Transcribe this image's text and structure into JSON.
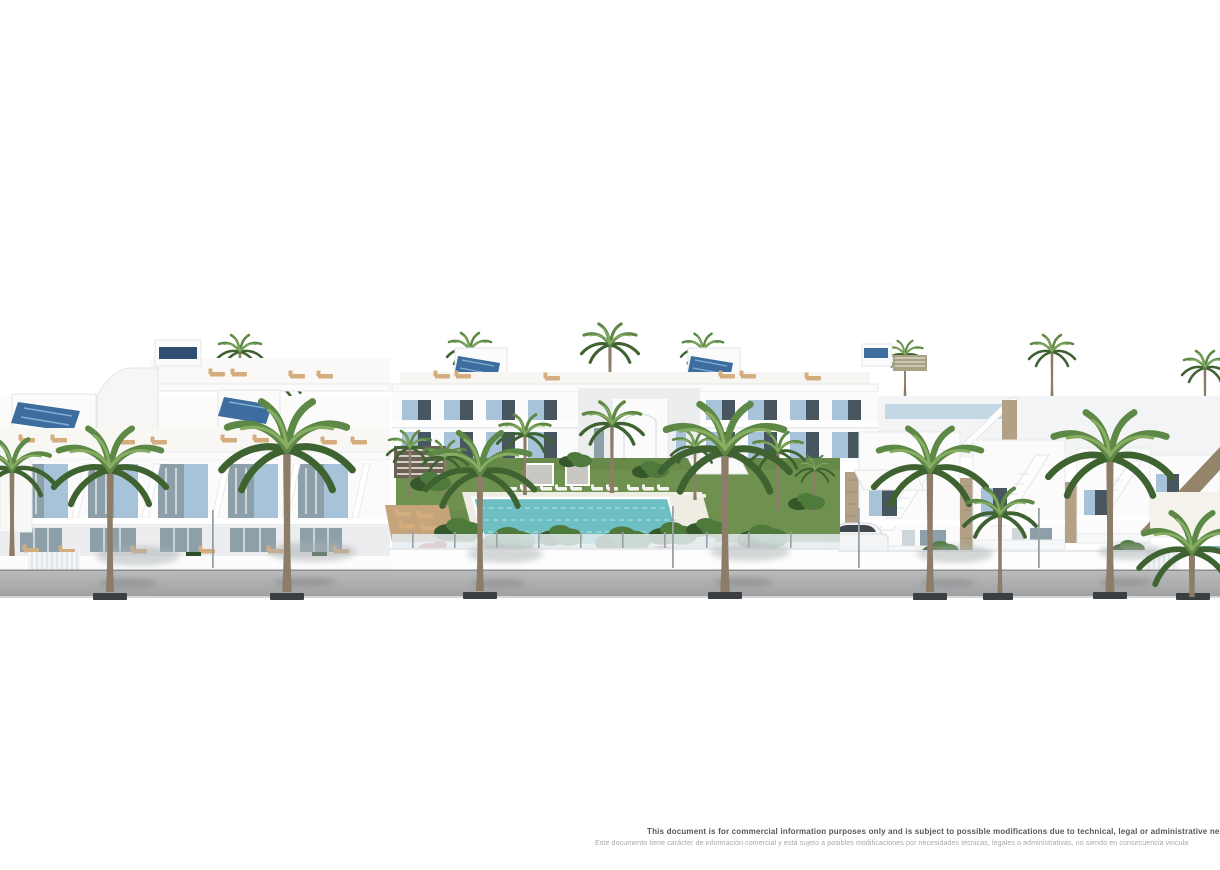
{
  "disclaimer": {
    "line_en": "This document is for commercial information purposes only and is subject to possible modifications due to technical, legal or administrative needs, and is t",
    "line_es": "Este documento tiene carácter de información comercial y está sujeto a posibles modificaciones por necesidades técnicas, legales o administrativas, no siendo en consecuencia vincula"
  },
  "scene": {
    "type": "architectural-render",
    "elements": [
      "white apartment building with blue shutters (left)",
      "rear apartment row with roof terraces and solar panels",
      "white townhouses with external staircases and stone cladding (right)",
      "communal lawn garden with turquoise swimming pool and white sun loungers",
      "palm trees along street and inside garden",
      "white perimeter wall with glass fence",
      "gray sidewalk with tree grates",
      "parked white car"
    ]
  },
  "colors": {
    "background": "#ffffff",
    "building_white": "#fbfbfb",
    "building_shade": "#ecedef",
    "building_shadow": "#dcdfe2",
    "window_dark": "#47565f",
    "window_mid": "#8da0aa",
    "shutter_blue": "#a7c3d9",
    "shutter_blue_dark": "#8db0c9",
    "solar_panel_blue": "#3d6c9e",
    "solar_panel_light": "#85aed2",
    "lawn_green": "#6f9150",
    "lawn_green_dark": "#5a7a3e",
    "bush_green": "#4e7a3c",
    "bush_green_dark": "#35572a",
    "palm_green": "#5d8845",
    "palm_green_dark": "#3f6231",
    "palm_green_light": "#86ad62",
    "palm_trunk": "#8d7d68",
    "pool_turquoise": "#6dbfc3",
    "pool_light": "#9fd8d8",
    "deck_wood": "#c5a47c",
    "lounger_tan": "#d4ad7e",
    "lounger_white": "#f4f2ec",
    "stone_cladding": "#b2a184",
    "stone_dark": "#94846a",
    "sidewalk_gray": "#a9aaac",
    "sidewalk_light": "#c3c4c6",
    "tree_grate": "#3b3f42",
    "glass_fence": "#e4ebee",
    "fence_post": "#97a1a8",
    "car_white": "#f3f4f5",
    "car_glass": "#3f474d",
    "flower_red": "#b2402e",
    "pergola_dark": "#6b6154",
    "pergola_olive": "#a8a183",
    "disclaimer_dark": "#57585c",
    "disclaimer_light": "#a7a8aa"
  }
}
